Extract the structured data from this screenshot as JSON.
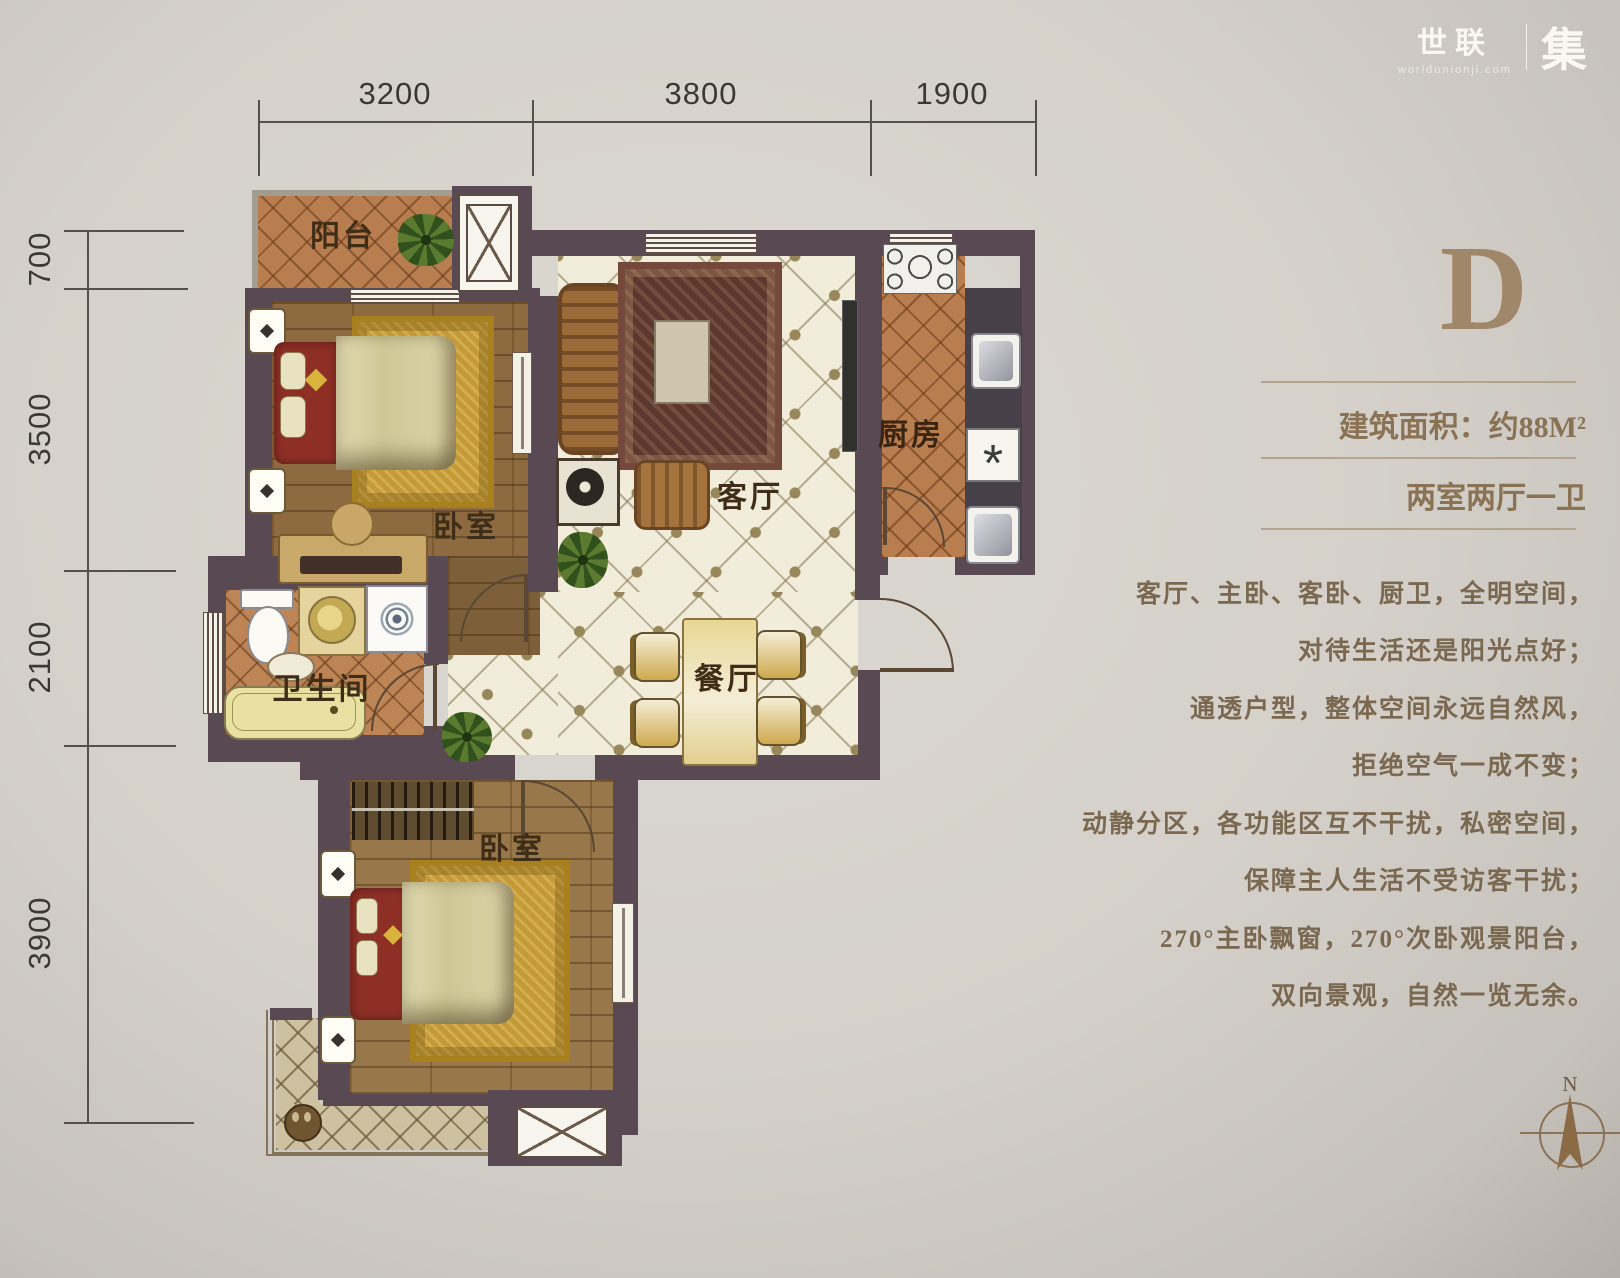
{
  "logo": {
    "brand": "世联",
    "domain": "worldunionji.com",
    "mark": "集"
  },
  "panel": {
    "unit": "D",
    "area": "建筑面积：约88M²",
    "layout": "两室两厅一卫",
    "lines": [
      "客厅、主卧、客卧、厨卫，全明空间，",
      "对待生活还是阳光点好；",
      "通透户型，整体空间永远自然风，",
      "拒绝空气一成不变；",
      "动静分区，各功能区互不干扰，私密空间，",
      "保障主人生活不受访客干扰；",
      "270°主卧飘窗，270°次卧观景阳台，",
      "双向景观，自然一览无余。"
    ]
  },
  "dims": {
    "top": [
      "3200",
      "3800",
      "1900"
    ],
    "left": [
      "700",
      "3500",
      "2100",
      "3900"
    ]
  },
  "rooms": {
    "balcony": "阳台",
    "bedroom_main": "卧室",
    "living": "客厅",
    "kitchen": "厨房",
    "bathroom": "卫生间",
    "dining": "餐厅",
    "bedroom_second": "卧室"
  },
  "compass": {
    "north": "N"
  },
  "colors": {
    "wall": "#584952",
    "terracotta_tile": "#b97e4f",
    "wood_floor": "#8d6a40",
    "cream_tile": "#f1edda",
    "panel_text": "#7a6850",
    "panel_letter": "#a1876a"
  }
}
